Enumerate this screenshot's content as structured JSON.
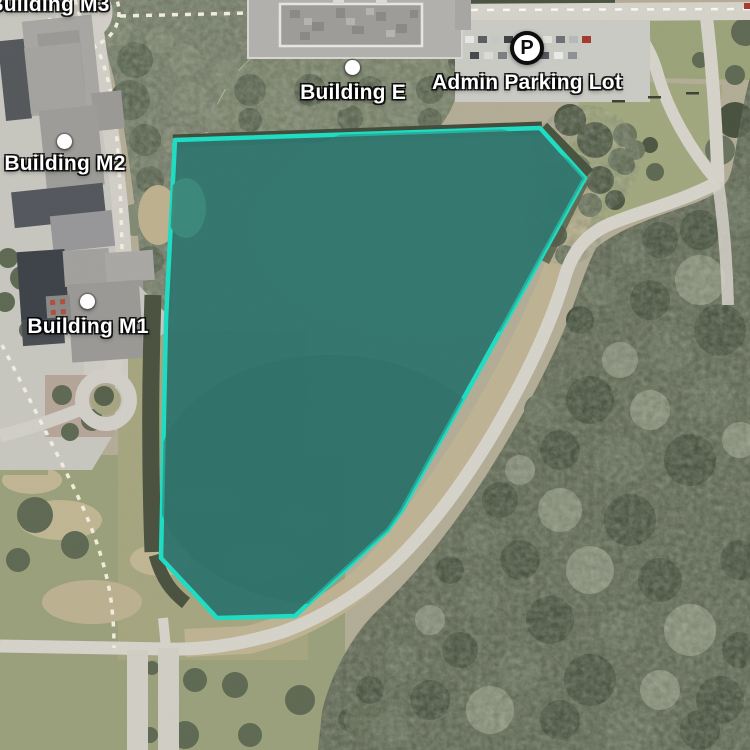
{
  "markers": [
    {
      "id": "building-m3",
      "label": "Building M3"
    },
    {
      "id": "building-m2",
      "label": "Building M2"
    },
    {
      "id": "building-m1",
      "label": "Building M1"
    },
    {
      "id": "building-e",
      "label": "Building E"
    },
    {
      "id": "admin-parking-lot",
      "label": "Admin Parking Lot"
    }
  ],
  "parking_badge": {
    "letter": "P"
  },
  "overlay": {
    "polygon_points": "175,140 540,128 585,178 402,510 388,530 295,616 217,618 161,558 166,320",
    "fill_color": "#2f756d",
    "stroke_color": "#1ddfc4"
  }
}
